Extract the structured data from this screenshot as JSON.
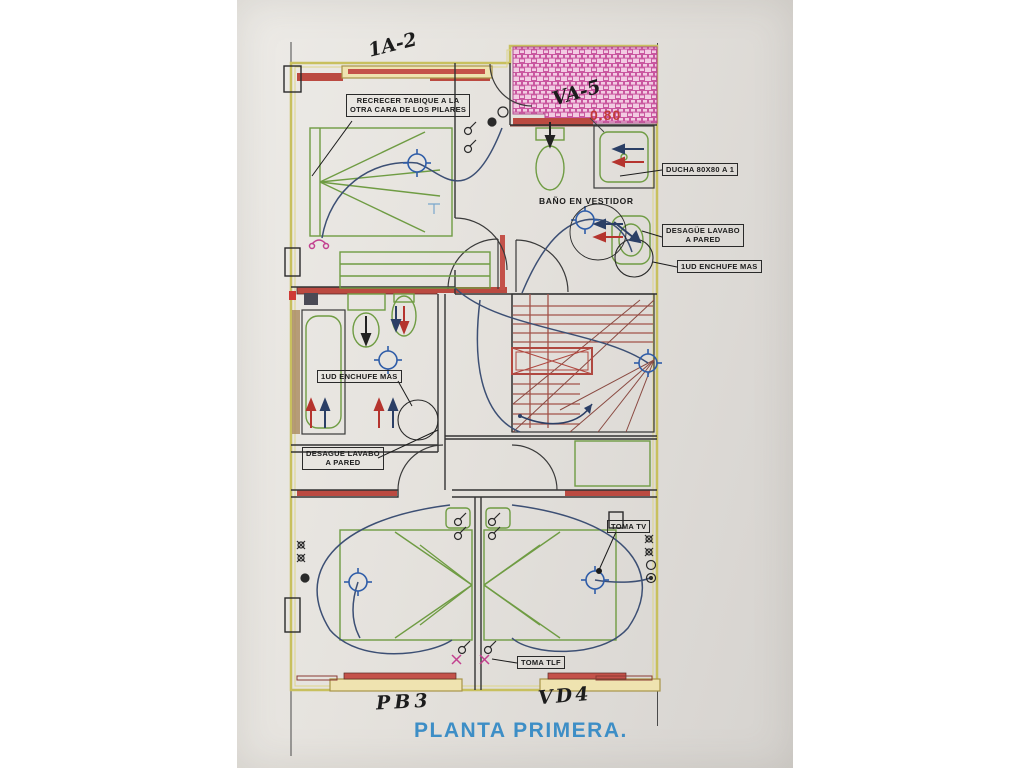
{
  "drawing": {
    "title": "PLANTA PRIMERA.",
    "notes": {
      "recrecer_line1": "RECRECER TABIQUE A LA",
      "recrecer_line2": "OTRA CARA DE LOS PILARES",
      "bano_vestidor": "BAÑO EN VESTIDOR",
      "ducha": "DUCHA 80X80 A 1",
      "desague_right_line1": "DESAGÜE LAVABO",
      "desague_right_line2": "A PARED",
      "enchufe_right": "1UD ENCHUFE MAS",
      "enchufe_left": "1UD ENCHUFE MAS",
      "desague_left_line1": "DESAGUE LAVABO",
      "desague_left_line2": "A PARED",
      "toma_tv": "TOMA TV",
      "toma_tlf": "TOMA TLF"
    },
    "handwritten": {
      "top_window": "1A-2",
      "hatch_area": "VA-5",
      "dimension": "0.80",
      "bottom_left_window": "PB3",
      "bottom_right_window": "VD4"
    },
    "colors": {
      "paper": "#e4e1dc",
      "wall_red": "#bb4a41",
      "boundary_olive": "#c8c05e",
      "fixture_green": "#6f9c43",
      "wiring_blue": "#3c4f74",
      "electric_blue": "#2f5da8",
      "hatch_pink": "#d86cb0",
      "stair_red": "#a2534a",
      "title_blue": "#3d8ec6",
      "annotation_red": "#c23b38"
    }
  }
}
